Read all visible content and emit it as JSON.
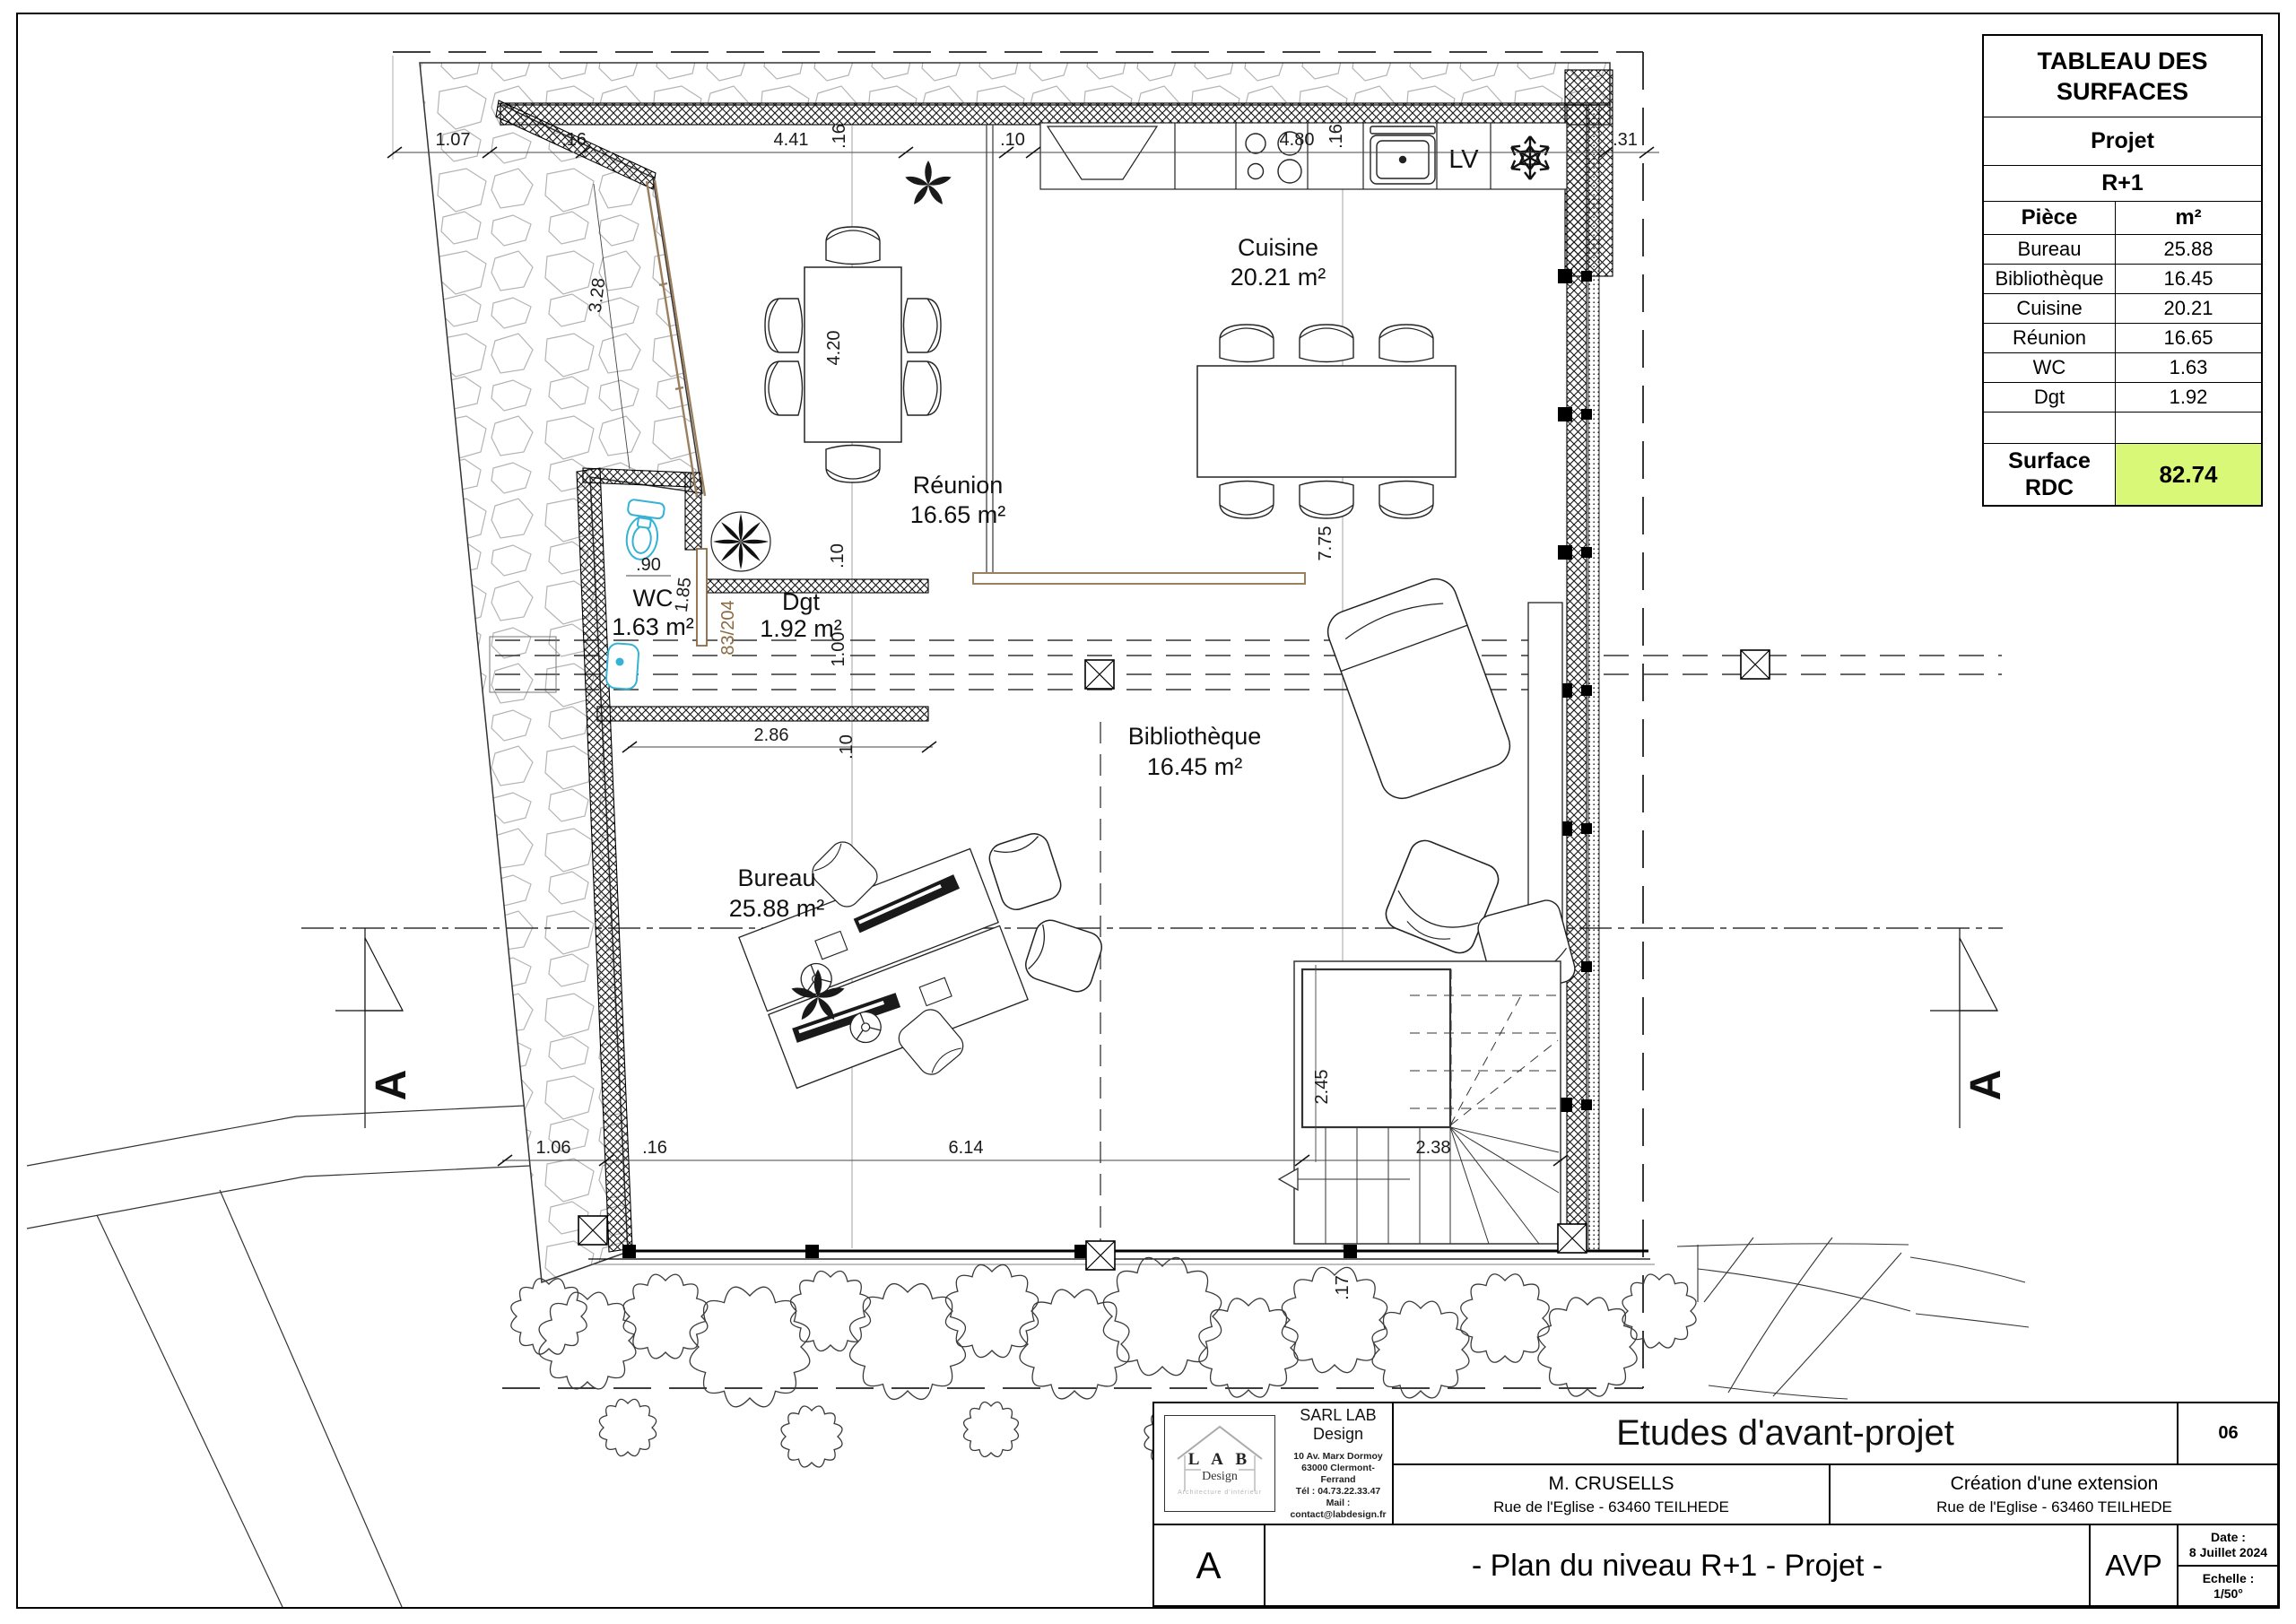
{
  "surface_table": {
    "title": "TABLEAU DES SURFACES",
    "project": "Projet",
    "level": "R+1",
    "col_room": "Pièce",
    "col_area": "m²",
    "rows": [
      {
        "room": "Bureau",
        "area": "25.88"
      },
      {
        "room": "Bibliothèque",
        "area": "16.45"
      },
      {
        "room": "Cuisine",
        "area": "20.21"
      },
      {
        "room": "Réunion",
        "area": "16.65"
      },
      {
        "room": "WC",
        "area": "1.63"
      },
      {
        "room": "Dgt",
        "area": "1.92"
      }
    ],
    "total_label": "Surface RDC",
    "total_value": "82.74",
    "highlight_color": "#d9f878"
  },
  "rooms": {
    "cuisine": {
      "name": "Cuisine",
      "area": "20.21 m²"
    },
    "reunion": {
      "name": "Réunion",
      "area": "16.65 m²"
    },
    "wc": {
      "name": "WC",
      "area": "1.63 m²"
    },
    "dgt": {
      "name": "Dgt",
      "area": "1.92 m²"
    },
    "bibliotheque": {
      "name": "Bibliothèque",
      "area": "16.45 m²"
    },
    "bureau": {
      "name": "Bureau",
      "area": "25.88 m²"
    }
  },
  "dims": {
    "d107": "1.07",
    "d16": ".16",
    "d441": "4.41",
    "d10": ".10",
    "d480": "4.80",
    "d31": ".31",
    "d328": "3.28",
    "d420": "4.20",
    "d775": "7.75",
    "d90": ".90",
    "d185": "1.85",
    "d100": "1.00",
    "d286": "2.86",
    "d245": "2.45",
    "d238": "2.38",
    "d17": ".17",
    "d106": "1.06",
    "d614": "6.14",
    "door_code": "83/204",
    "lv": "LV"
  },
  "section": {
    "label": "A"
  },
  "title_block": {
    "company": "SARL LAB Design",
    "logo": {
      "line1": "L A B",
      "line2": "Design",
      "tagline": "Architecture d'intérieur"
    },
    "address": [
      "10 Av. Marx Dormoy",
      "63000 Clermont-Ferrand",
      "Tél : 04.73.22.33.47",
      "Mail : contact@labdesign.fr"
    ],
    "doc_title": "Etudes d'avant-projet",
    "sheet_number": "06",
    "client_name": "M. CRUSELLS",
    "client_address": "Rue de l'Eglise -  63460 TEILHEDE",
    "project_name": "Création d'une extension",
    "project_address": "Rue de l'Eglise -  63460 TEILHEDE",
    "index": "A",
    "drawing_title": "- Plan du niveau R+1 - Projet -",
    "phase": "AVP",
    "date_label": "Date :",
    "date_value": "8 Juillet 2024",
    "scale_label": "Echelle :",
    "scale_value": "1/50°"
  }
}
